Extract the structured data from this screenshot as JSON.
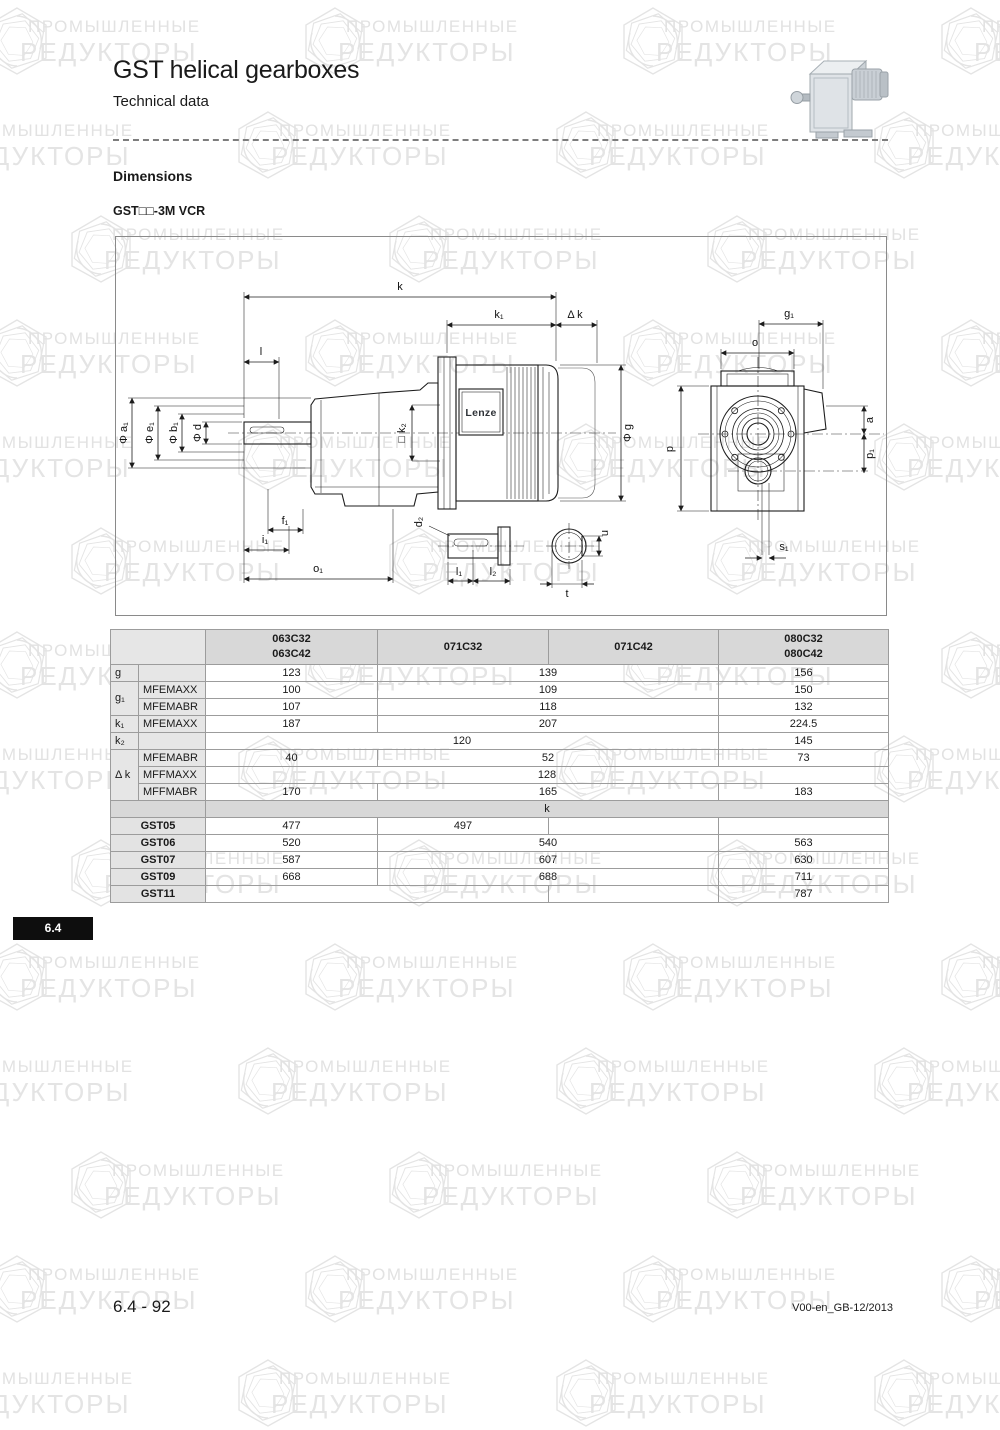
{
  "page": {
    "title": "GST helical gearboxes",
    "subtitle": "Technical data",
    "section_heading": "Dimensions",
    "variant_label": "GST□□-3M VCR",
    "section_tab": "6.4",
    "footer_left": "6.4 - 92",
    "footer_right": "V00-en_GB-12/2013"
  },
  "watermark": {
    "line1": "ПРОМЫШЛЕННЫЕ",
    "line2": "РЕДУКТОРЫ",
    "color": "#e3e3e3"
  },
  "diagram": {
    "motor_brand": "Lenze",
    "labels": {
      "k": "k",
      "k1": "k₁",
      "dk": "Δ k",
      "l": "l",
      "a1": "Φ a₁",
      "e1": "Φ e₁",
      "b1": "Φ b₁",
      "d": "Φ d",
      "k2": "□ k₂",
      "g": "Φ g",
      "f1": "f₁",
      "i1": "i₁",
      "o1": "o₁",
      "d2": "d₂",
      "l1": "l₁",
      "l2": "l₂",
      "t": "t",
      "u": "u",
      "g1": "g₁",
      "o": "o",
      "p": "p",
      "a": "a",
      "p1": "p₁",
      "s1": "s₁"
    }
  },
  "table": {
    "columns": [
      "",
      "",
      "063C32\n063C42",
      "071C32",
      "071C42",
      "080C32\n080C42"
    ],
    "rows": [
      {
        "cells": [
          {
            "t": "",
            "cs": 2,
            "c": "lbl hdr"
          },
          {
            "t": "063C32\n063C42",
            "c": "hdr"
          },
          {
            "t": "071C32",
            "c": "hdr"
          },
          {
            "t": "071C42",
            "c": "hdr"
          },
          {
            "t": "080C32\n080C42",
            "c": "hdr"
          }
        ]
      },
      {
        "cells": [
          {
            "t": "g",
            "c": "lbl"
          },
          {
            "t": "",
            "c": "lbl"
          },
          {
            "t": "123",
            "c": "val"
          },
          {
            "t": "139",
            "cs": 2,
            "c": "val"
          },
          {
            "t": "156",
            "c": "val"
          }
        ]
      },
      {
        "cells": [
          {
            "t": "g₁",
            "rs": 2,
            "c": "lbl"
          },
          {
            "t": "MFEMAXX",
            "c": "lbl"
          },
          {
            "t": "100",
            "c": "val"
          },
          {
            "t": "109",
            "cs": 2,
            "c": "val"
          },
          {
            "t": "150",
            "c": "val"
          }
        ]
      },
      {
        "cells": [
          {
            "t": "MFEMABR",
            "c": "lbl"
          },
          {
            "t": "107",
            "c": "val"
          },
          {
            "t": "118",
            "cs": 2,
            "c": "val"
          },
          {
            "t": "132",
            "c": "val"
          }
        ]
      },
      {
        "cells": [
          {
            "t": "k₁",
            "c": "lbl"
          },
          {
            "t": "MFEMAXX",
            "c": "lbl"
          },
          {
            "t": "187",
            "c": "val"
          },
          {
            "t": "207",
            "cs": 2,
            "c": "val"
          },
          {
            "t": "224.5",
            "c": "val"
          }
        ]
      },
      {
        "cells": [
          {
            "t": "k₂",
            "c": "lbl"
          },
          {
            "t": "",
            "c": "lbl"
          },
          {
            "t": "120",
            "cs": 3,
            "c": "val"
          },
          {
            "t": "145",
            "c": "val"
          }
        ]
      },
      {
        "cells": [
          {
            "t": "Δ k",
            "rs": 3,
            "c": "lbl"
          },
          {
            "t": "MFEMABR",
            "c": "lbl"
          },
          {
            "t": "40",
            "c": "val"
          },
          {
            "t": "52",
            "cs": 2,
            "c": "val"
          },
          {
            "t": "73",
            "c": "val"
          }
        ]
      },
      {
        "cells": [
          {
            "t": "MFFMAXX",
            "c": "lbl"
          },
          {
            "t": "128",
            "cs": 4,
            "c": "val"
          }
        ]
      },
      {
        "cells": [
          {
            "t": "MFFMABR",
            "c": "lbl"
          },
          {
            "t": "170",
            "c": "val"
          },
          {
            "t": "165",
            "cs": 2,
            "c": "val"
          },
          {
            "t": "183",
            "c": "val"
          }
        ]
      },
      {
        "cells": [
          {
            "t": "",
            "cs": 2,
            "c": "lbl sec"
          },
          {
            "t": "k",
            "cs": 4,
            "c": "sec"
          }
        ]
      },
      {
        "cells": [
          {
            "t": "GST05",
            "cs": 2,
            "c": "gst"
          },
          {
            "t": "477",
            "c": "val"
          },
          {
            "t": "497",
            "c": "val"
          },
          {
            "t": "",
            "c": "val"
          },
          {
            "t": "",
            "c": "val"
          }
        ]
      },
      {
        "cells": [
          {
            "t": "GST06",
            "cs": 2,
            "c": "gst"
          },
          {
            "t": "520",
            "c": "val"
          },
          {
            "t": "540",
            "cs": 2,
            "c": "val"
          },
          {
            "t": "563",
            "c": "val"
          }
        ]
      },
      {
        "cells": [
          {
            "t": "GST07",
            "cs": 2,
            "c": "gst"
          },
          {
            "t": "587",
            "c": "val"
          },
          {
            "t": "607",
            "cs": 2,
            "c": "val"
          },
          {
            "t": "630",
            "c": "val"
          }
        ]
      },
      {
        "cells": [
          {
            "t": "GST09",
            "cs": 2,
            "c": "gst"
          },
          {
            "t": "668",
            "c": "val"
          },
          {
            "t": "688",
            "cs": 2,
            "c": "val"
          },
          {
            "t": "711",
            "c": "val"
          }
        ]
      },
      {
        "cells": [
          {
            "t": "GST11",
            "cs": 2,
            "c": "gst"
          },
          {
            "t": "",
            "cs": 2,
            "c": "val"
          },
          {
            "t": "",
            "c": "val"
          },
          {
            "t": "787",
            "c": "val"
          }
        ]
      }
    ]
  }
}
